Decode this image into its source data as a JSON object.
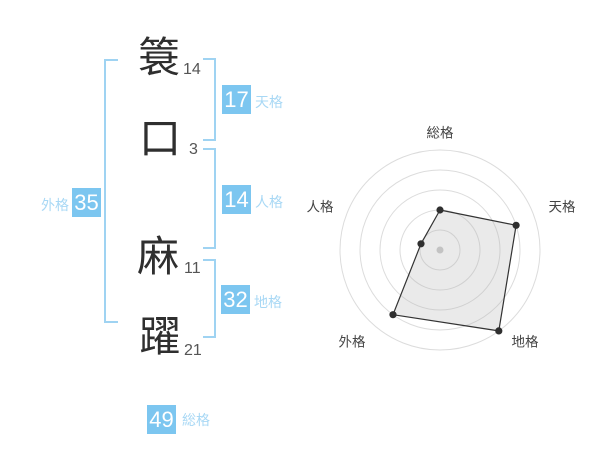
{
  "colors": {
    "background": "#ffffff",
    "badge_bg": "#7cc6f0",
    "badge_text": "#ffffff",
    "kaku_label_text": "#a8d8f5",
    "bracket": "#9fd3f2",
    "character_text": "#2f2f2f",
    "stroke_number_text": "#555555"
  },
  "name_panel": {
    "characters": [
      {
        "glyph": "簑",
        "strokes": "14"
      },
      {
        "glyph": "口",
        "strokes": "3"
      },
      {
        "glyph": "麻",
        "strokes": "11"
      },
      {
        "glyph": "躍",
        "strokes": "21"
      }
    ],
    "kaku": {
      "tenkaku": {
        "value": "17",
        "label": "天格"
      },
      "jinkaku": {
        "value": "14",
        "label": "人格"
      },
      "chikaku": {
        "value": "32",
        "label": "地格"
      },
      "gaikaku": {
        "value": "35",
        "label": "外格"
      },
      "soukaku": {
        "value": "49",
        "label": "総格"
      }
    }
  },
  "chart_data": {
    "type": "radar",
    "categories": [
      "総格",
      "天格",
      "地格",
      "外格",
      "人格"
    ],
    "values": [
      2,
      4,
      5,
      4,
      1
    ],
    "max": 5,
    "rings": 5,
    "start_angle_deg": -90,
    "direction": "clockwise",
    "legend": "none",
    "grid": "concentric-circles",
    "ring_color": "#dcdcdc",
    "polygon_fill": "rgba(180,180,180,0.28)",
    "polygon_stroke": "#333333",
    "point_color": "#2f2f2f",
    "center_dot_color": "#c9c9c9",
    "label_color": "#444444"
  }
}
